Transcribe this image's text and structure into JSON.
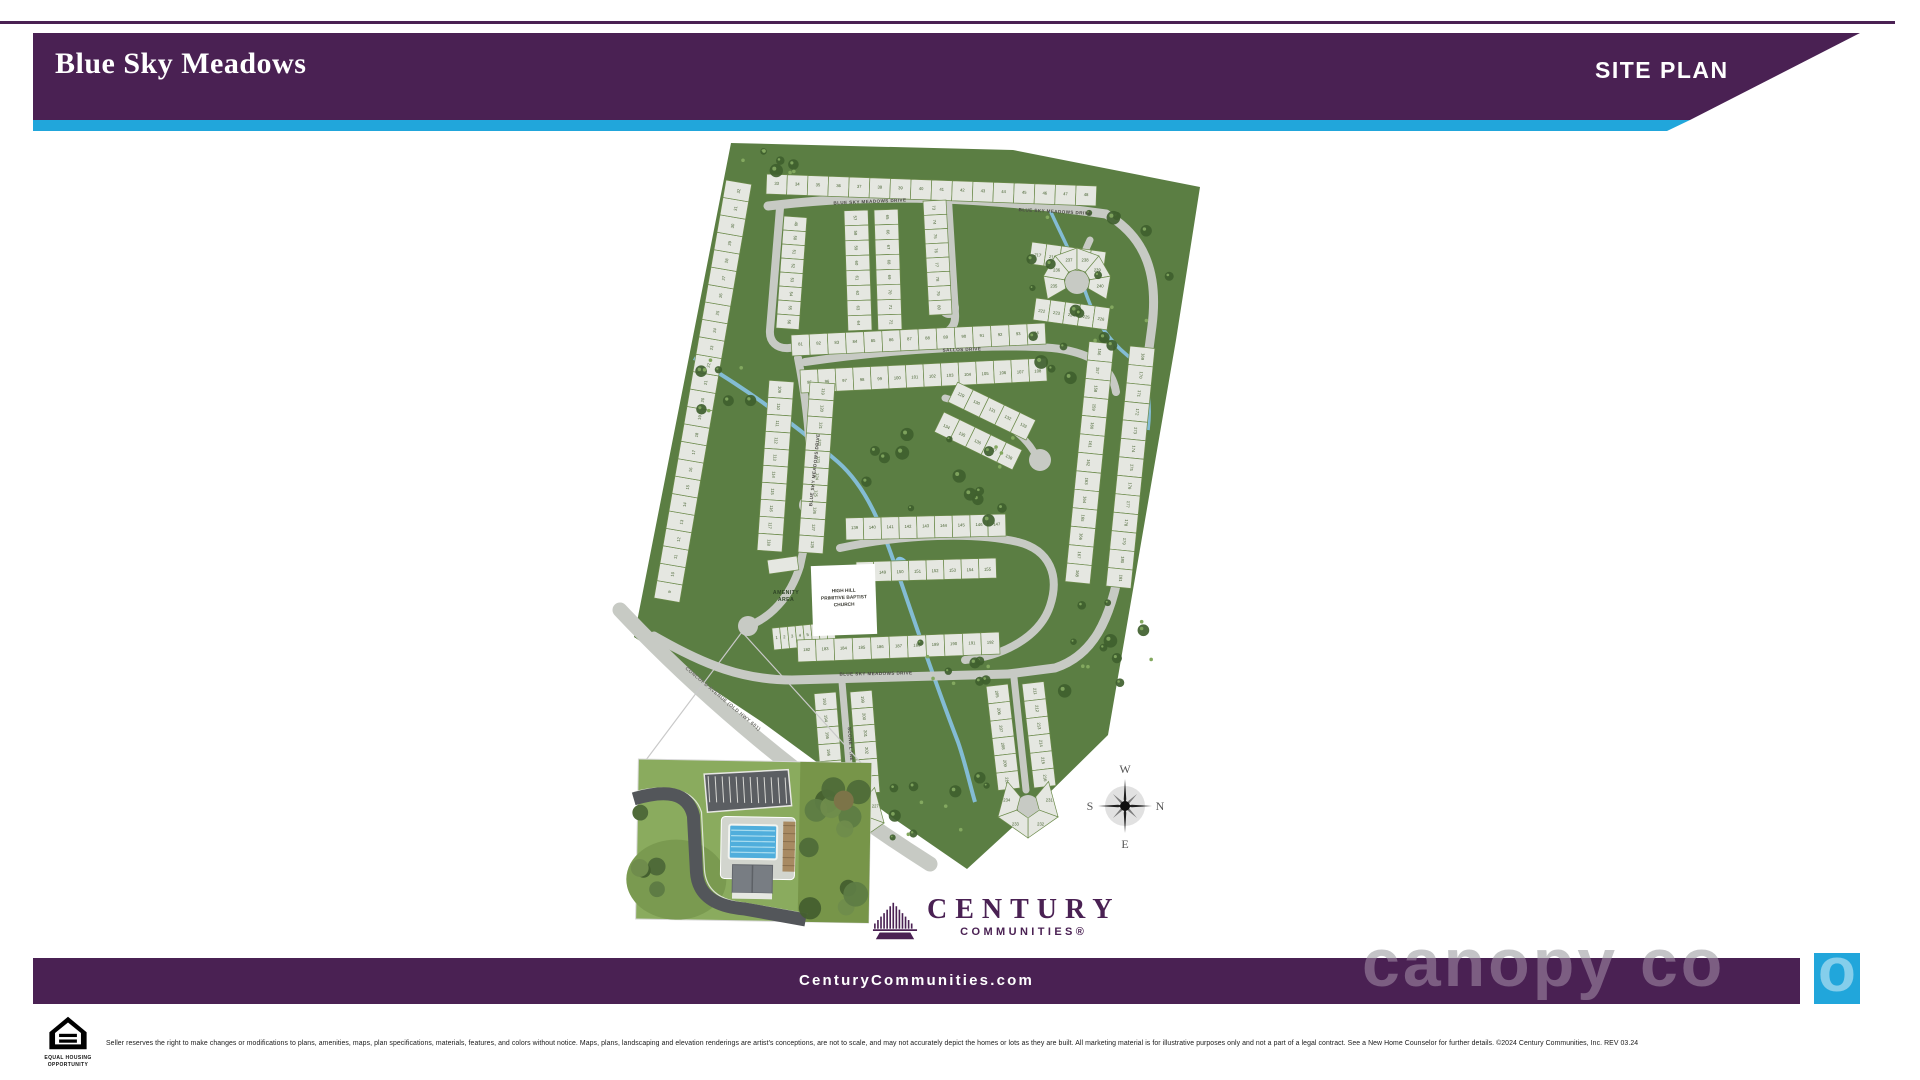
{
  "header": {
    "title": "Blue Sky Meadows",
    "label": "SITE PLAN"
  },
  "map": {
    "streets": [
      "BLUE SKY MEADOWS DRIVE",
      "SALLOS DRIVE",
      "SCONE LANE",
      "CONCORD AVENUE (OLD HWY 601)"
    ],
    "labels": {
      "amenity": [
        "AMENITY",
        "AREA"
      ],
      "church": [
        "HIGH HILL",
        "PRIMITIVE BAPTIST",
        "CHURCH"
      ]
    },
    "compass": {
      "top": "W",
      "right": "N",
      "bottom": "E",
      "left": "S"
    },
    "lots": {
      "first": 1,
      "last": 309
    }
  },
  "brand": {
    "name": "CENTURY",
    "subtitle": "COMMUNITIES®",
    "website": "CenturyCommunities.com"
  },
  "legal": {
    "eho_line1": "EQUAL HOUSING",
    "eho_line2": "OPPORTUNITY",
    "disclaimer": "Seller reserves the right to make changes or modifications to plans, amenities, maps, plan specifications, materials, features, and colors without notice. Maps, plans, landscaping and elevation renderings are artist's conceptions, are not to scale, and may not accurately depict the homes or lots as they are built. All marketing material is for illustrative purposes only and not a part of a legal contract. See a New Home Counselor for further details. ©2024 Century Communities, Inc. REV 03.24"
  },
  "watermark": {
    "text": "canopy co"
  },
  "colors": {
    "purple": "#4A2153",
    "cyan": "#21A6DB",
    "map_green": "#5B7E43",
    "tree_green": "#3F5F2E",
    "road": "#C7CAC4",
    "lot": "#E5E7E1",
    "lot_stroke": "#6B8A4A",
    "stream": "#87C3E4",
    "lot_text": "#44602E"
  }
}
